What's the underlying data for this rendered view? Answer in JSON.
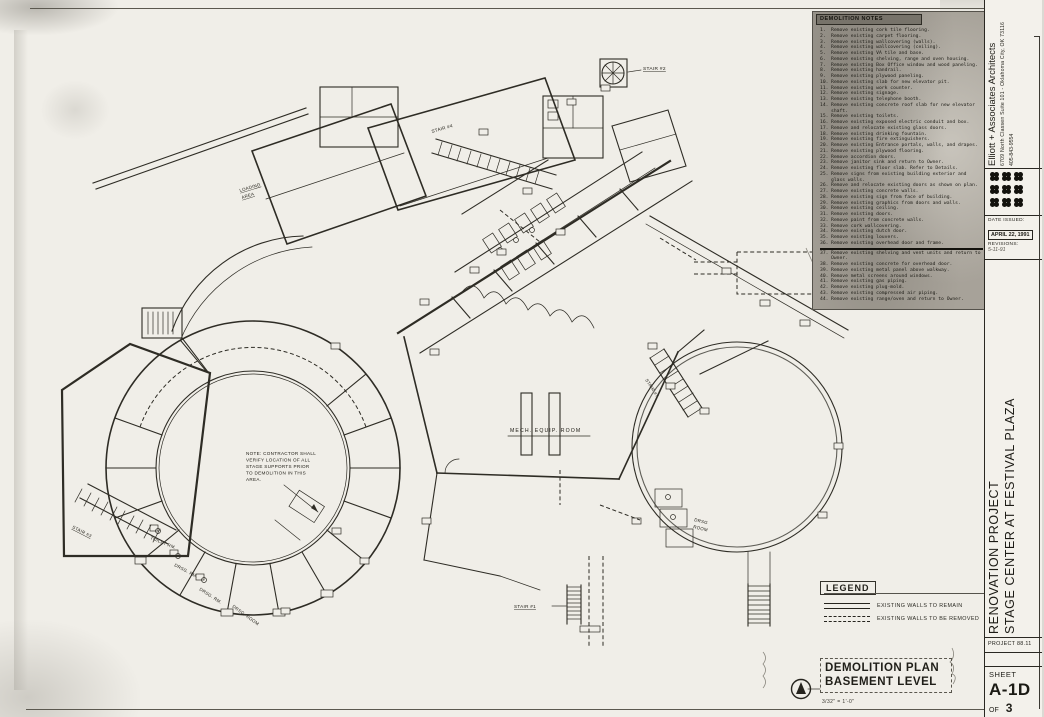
{
  "colors": {
    "paper": "#f0eee8",
    "ink": "#2e2c25",
    "notes_panel_bg": "#a7a299",
    "notes_header_bg": "#77736a"
  },
  "notes_panel": {
    "title": "DEMOLITION NOTES",
    "items": [
      {
        "n": "1.",
        "t": "Remove existing cork tile flooring."
      },
      {
        "n": "2.",
        "t": "Remove existing carpet flooring."
      },
      {
        "n": "3.",
        "t": "Remove existing wallcovering (walls)."
      },
      {
        "n": "4.",
        "t": "Remove existing wallcovering (ceiling)."
      },
      {
        "n": "5.",
        "t": "Remove existing VA tile and base."
      },
      {
        "n": "6.",
        "t": "Remove existing shelving, range and oven housing."
      },
      {
        "n": "7.",
        "t": "Remove existing Box Office window and wood paneling."
      },
      {
        "n": "8.",
        "t": "Remove existing handrail."
      },
      {
        "n": "9.",
        "t": "Remove existing plywood paneling."
      },
      {
        "n": "10.",
        "t": "Remove existing slab for new elevator pit."
      },
      {
        "n": "11.",
        "t": "Remove existing work counter."
      },
      {
        "n": "12.",
        "t": "Remove existing signage."
      },
      {
        "n": "13.",
        "t": "Remove existing telephone booth."
      },
      {
        "n": "14.",
        "t": "Remove existing concrete roof slab for new elevator shaft."
      },
      {
        "n": "15.",
        "t": "Remove existing toilets."
      },
      {
        "n": "16.",
        "t": "Remove existing exposed electric conduit and box."
      },
      {
        "n": "17.",
        "t": "Remove and relocate existing glass doors."
      },
      {
        "n": "18.",
        "t": "Remove existing drinking fountain."
      },
      {
        "n": "19.",
        "t": "Remove existing fire extinguishers."
      },
      {
        "n": "20.",
        "t": "Remove existing Entrance portals, walls, and drapes."
      },
      {
        "n": "21.",
        "t": "Remove existing plywood flooring."
      },
      {
        "n": "22.",
        "t": "Remove accordion doors."
      },
      {
        "n": "23.",
        "t": "Remove janitor sink and return to Owner."
      },
      {
        "n": "24.",
        "t": "Remove existing floor slab. Refer to Details."
      },
      {
        "n": "25.",
        "t": "Remove signs from existing building exterior and glass walls."
      },
      {
        "n": "26.",
        "t": "Remove and relocate existing doors as shown on plan."
      },
      {
        "n": "27.",
        "t": "Remove existing concrete walls."
      },
      {
        "n": "28.",
        "t": "Remove existing sign from face of building."
      },
      {
        "n": "29.",
        "t": "Remove existing graphics from doors and walls."
      },
      {
        "n": "30.",
        "t": "Remove existing ceiling."
      },
      {
        "n": "31.",
        "t": "Remove existing doors."
      },
      {
        "n": "32.",
        "t": "Remove paint from concrete walls."
      },
      {
        "n": "33.",
        "t": "Remove cork wallcovering."
      },
      {
        "n": "34.",
        "t": "Remove existing dutch door."
      },
      {
        "n": "35.",
        "t": "Remove existing louvers."
      },
      {
        "n": "36.",
        "t": "Remove existing overhead door and frame."
      },
      {
        "n": "37.",
        "t": "Remove existing shelving and vent units and return to Owner."
      },
      {
        "n": "38.",
        "t": "Remove existing concrete for overhead door."
      },
      {
        "n": "39.",
        "t": "Remove existing metal panel above walkway."
      },
      {
        "n": "40.",
        "t": "Remove metal screens around windows."
      },
      {
        "n": "41.",
        "t": "Remove existing gas piping."
      },
      {
        "n": "42.",
        "t": "Remove existing plug-mold."
      },
      {
        "n": "43.",
        "t": "Remove existing compressed air piping."
      },
      {
        "n": "44.",
        "t": "Remove existing range/oven and return to Owner."
      }
    ]
  },
  "legend": {
    "title": "LEGEND",
    "remain": "EXISTING WALLS TO REMAIN",
    "removed": "EXISTING WALLS TO BE REMOVED"
  },
  "plan_title": {
    "line1": "DEMOLITION PLAN",
    "line2": "BASEMENT LEVEL",
    "scale": "3/32\" = 1'-0\""
  },
  "titleblock": {
    "firm": "Elliott + Associates Architects",
    "address": "6709 North Classen   Suite 101  -  Oklahoma City, OK  73116",
    "phone": "405-843-9554",
    "date_issued_label": "DATE ISSUED:",
    "date_issued": "APRIL 22, 1991",
    "revisions_label": "REVISIONS:",
    "revision": "5-11-91",
    "project_line1": "RENOVATION PROJECT",
    "project_line2": "STAGE CENTER AT FESTIVAL PLAZA",
    "project_no": "PROJECT 88.11",
    "sheet_label": "SHEET",
    "sheet_no": "A-1D",
    "of_label": "OF",
    "of_total": "3"
  },
  "plan_labels": {
    "loading_line1": "LOADING",
    "loading_line2": "AREA",
    "stair_1": "STAIR #1",
    "stair_2": "STAIR #2",
    "stair_3": "STAIR #3",
    "stair_4": "STAIR #4",
    "stair_7": "STAIR #7",
    "mech_room": "MECH. EQUIP. ROOM",
    "toilet_rm": "TOILET RM.",
    "drsg_rm_1": "DRSG. RM.",
    "drsg_rm_2": "DRSG. RM.",
    "drsg_room_ring": "DRSG. ROOM",
    "drsg_b_line1": "DRSG",
    "drsg_b_line2": "ROOM",
    "contractor_note": [
      "NOTE: CONTRACTOR SHALL",
      "VERIFY LOCATION OF ALL",
      "STAGE SUPPORTS PRIOR",
      "TO DEMOLITION IN THIS",
      "AREA."
    ]
  }
}
